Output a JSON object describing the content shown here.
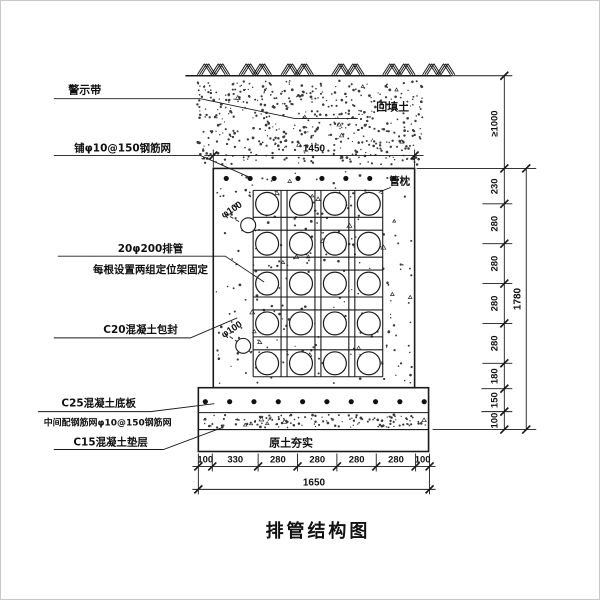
{
  "title": "排管结构图",
  "callouts": {
    "warning_tape": "警示带",
    "top_mesh": "铺φ10@150钢筋网",
    "pipes_line1": "20φ200排管",
    "pipes_line2": "每根设置两组定位架固定",
    "encasement": "C20混凝土包封",
    "slab_line1": "C25混凝土底板",
    "slab_line2": "中间配钢筋网φ10@150钢筋网",
    "cushion": "C15混凝土垫层",
    "backfill": "回填土",
    "pipe_pillow": "管枕",
    "compacted_soil": "原土夯实",
    "pipe_dia_upper": "φ100",
    "pipe_dia_lower": "φ100"
  },
  "dimensions": {
    "top_width": "1450",
    "bottom_segments": [
      "100",
      "330",
      "280",
      "280",
      "280",
      "280",
      "100"
    ],
    "bottom_total": "1650",
    "right_cover": "≥1000",
    "right_segments": [
      "230",
      "280",
      "280",
      "280",
      "280",
      "180",
      "150",
      "100"
    ],
    "right_total": "1780"
  },
  "colors": {
    "line": "#1a1a1a",
    "paper": "#ffffff"
  }
}
